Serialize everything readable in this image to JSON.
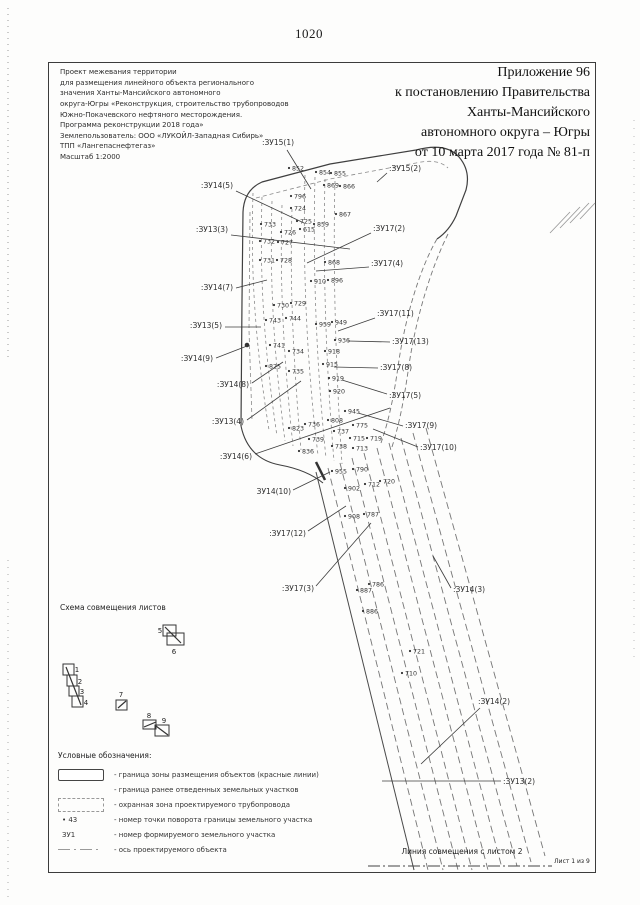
{
  "page": {
    "number": "1020",
    "match_line_label": "Линия совмещения с листом 2",
    "sheet_note": "Лист 1 из 9"
  },
  "header": {
    "title_lines": [
      "Приложение 96",
      "к постановлению Правительства",
      "Ханты-Мансийского",
      "автономного округа – Югры",
      "от 10 марта 2017 года № 81-п"
    ]
  },
  "project_info": {
    "lines": [
      "Проект межевания территории",
      "для размещения линейного объекта регионального",
      "значения Ханты-Мансийского автономного",
      "округа-Югры «Реконструкция, строительство трубопроводов",
      "Южно-Покачевского нефтяного месторождения.",
      "Программа реконструкции 2018 года»",
      "Землепользователь: ООО «ЛУКОЙЛ-Западная Сибирь»",
      "ТПП «Лангепаснефтегаз»",
      "Масштаб 1:2000"
    ]
  },
  "scheme": {
    "title": "Схема совмещения листов",
    "sheets": [
      {
        "n": "1",
        "x": 63,
        "y": 664,
        "w": 11,
        "h": 11,
        "nx": 77,
        "ny": 672
      },
      {
        "n": "2",
        "x": 67,
        "y": 675,
        "w": 10,
        "h": 11,
        "nx": 80,
        "ny": 684
      },
      {
        "n": "3",
        "x": 69,
        "y": 686,
        "w": 10,
        "h": 10,
        "nx": 82,
        "ny": 694
      },
      {
        "n": "4",
        "x": 72,
        "y": 696,
        "w": 11,
        "h": 11,
        "nx": 86,
        "ny": 705
      },
      {
        "n": "5",
        "x": 163,
        "y": 625,
        "w": 13,
        "h": 11,
        "nx": 160,
        "ny": 633
      },
      {
        "n": "6",
        "x": 167,
        "y": 633,
        "w": 17,
        "h": 12,
        "nx": 174,
        "ny": 654
      },
      {
        "n": "7",
        "x": 116,
        "y": 700,
        "w": 11,
        "h": 10,
        "nx": 121,
        "ny": 697
      },
      {
        "n": "8",
        "x": 143,
        "y": 720,
        "w": 13,
        "h": 9,
        "nx": 149,
        "ny": 718
      },
      {
        "n": "9",
        "x": 155,
        "y": 725,
        "w": 14,
        "h": 11,
        "nx": 164,
        "ny": 723
      }
    ],
    "links": [
      "M66,667 L81,705",
      "M165,627 L181,643",
      "M118,708 L126,701",
      "M144,727 L156,722",
      "M156,726 L168,735"
    ]
  },
  "legend": {
    "title": "Условные обозначения:",
    "items": [
      {
        "symbol": "solid-rect",
        "symbol_text": "",
        "text": "- граница зоны размещения объектов (красные линии)"
      },
      {
        "symbol": "none",
        "symbol_text": "",
        "text": "- граница ранее отведенных земельных участков"
      },
      {
        "symbol": "dashed-rect",
        "symbol_text": "",
        "text": "- охранная зона проектируемого трубопровода"
      },
      {
        "symbol": "point",
        "symbol_text": "• 43",
        "text": "- номер точки поворота границы земельного участка"
      },
      {
        "symbol": "zu",
        "symbol_text": "ЗУ1",
        "text": "- номер формируемого земельного участка"
      },
      {
        "symbol": "axis",
        "symbol_text": "",
        "text": "- ось проектируемого объекта"
      }
    ]
  },
  "map": {
    "colors": {
      "boundary": "#3f3f3f",
      "corridor": "#757575",
      "inner": "#8a8a8a",
      "leader": "#3d3d3d",
      "text": "#2e2e2e"
    },
    "paths": [
      {
        "name": "zone-boundary",
        "d": "M241,426 L242,300 L243,212 Q244,190 262,182 L330,164 L416,150 Q446,142 459,157 Q471,171 466,190 L456,216 Q449,231 437,239",
        "w": 1.2,
        "c": "#3f3f3f"
      },
      {
        "name": "zone-boundary-inner-top",
        "d": "M256,198 L330,179 L416,163 Q438,158 448,168",
        "w": 0.8,
        "c": "#8a8a8a",
        "dash": "4,3"
      },
      {
        "name": "zone-boundary-inner-left",
        "d": "M250,212 L249,330 L252,420",
        "w": 0.8,
        "c": "#8a8a8a",
        "dash": "4,3"
      },
      {
        "name": "zone-boundary-bottom-curve",
        "d": "M241,426 Q248,459 280,465 Q307,470 323,483",
        "w": 1.1,
        "c": "#3f3f3f"
      },
      {
        "name": "corridor-right-1",
        "d": "M437,239 C420,268 406,315 399,360 C394,396 389,420 381,443",
        "w": 0.9,
        "c": "#777777",
        "dash": "5,3"
      },
      {
        "name": "corridor-right-2",
        "d": "M448,234 C431,268 416,318 409,365 C404,400 399,426 391,450",
        "w": 0.9,
        "c": "#777777",
        "dash": "5,3"
      },
      {
        "name": "corridor-v1",
        "d": "M253,193 C251,260 253,330 269,430",
        "w": 0.8,
        "c": "#8a8a8a",
        "dash": "3,3"
      },
      {
        "name": "corridor-v2",
        "d": "M262,197 C260,265 262,335 277,436",
        "w": 0.8,
        "c": "#8a8a8a",
        "dash": "3,3"
      },
      {
        "name": "corridor-v3",
        "d": "M272,201 C270,270 272,340 285,441",
        "w": 0.8,
        "c": "#8a8a8a",
        "dash": "3,3"
      },
      {
        "name": "corridor-v4",
        "d": "M282,205 C280,272 282,342 293,446",
        "w": 0.8,
        "c": "#8a8a8a",
        "dash": "3,3"
      },
      {
        "name": "corridor-v5",
        "d": "M292,209 C290,275 292,345 301,450",
        "w": 0.8,
        "c": "#8a8a8a",
        "dash": "3,3"
      },
      {
        "name": "corridor-v6",
        "d": "M305,175 C303,250 305,350 318,455",
        "w": 0.8,
        "c": "#8a8a8a",
        "dash": "3,3"
      },
      {
        "name": "corridor-v7",
        "d": "M315,177 C313,252 315,352 326,458",
        "w": 0.8,
        "c": "#8a8a8a",
        "dash": "3,3"
      },
      {
        "name": "corridor-v8",
        "d": "M325,179 C323,255 325,355 334,461",
        "w": 0.8,
        "c": "#8a8a8a",
        "dash": "3,3"
      },
      {
        "name": "corridor-v9",
        "d": "M335,181 C333,258 335,358 342,464",
        "w": 0.8,
        "c": "#8a8a8a",
        "dash": "3,3"
      },
      {
        "name": "corridor-l1",
        "d": "M316,472 L414,870",
        "w": 1.0,
        "c": "#4a4a4a"
      },
      {
        "name": "corridor-l2",
        "d": "M328,468 L428,870",
        "w": 0.9,
        "c": "#757575",
        "dash": "7,4"
      },
      {
        "name": "corridor-l3",
        "d": "M340,463 L443,870",
        "w": 0.9,
        "c": "#757575",
        "dash": "7,4"
      },
      {
        "name": "corridor-l4",
        "d": "M352,458 L458,870",
        "w": 0.9,
        "c": "#757575",
        "dash": "7,4"
      },
      {
        "name": "corridor-l5",
        "d": "M364,453 L472,870",
        "w": 0.9,
        "c": "#757575",
        "dash": "7,4"
      },
      {
        "name": "corridor-l6",
        "d": "M377,448 L488,870",
        "w": 0.9,
        "c": "#757575",
        "dash": "7,4"
      },
      {
        "name": "corridor-l7",
        "d": "M389,443 L502,868",
        "w": 0.9,
        "c": "#757575",
        "dash": "7,4"
      },
      {
        "name": "corridor-l8",
        "d": "M401,438 L517,866",
        "w": 0.9,
        "c": "#757575",
        "dash": "7,4"
      },
      {
        "name": "corridor-l9",
        "d": "M413,433 L531,862",
        "w": 0.9,
        "c": "#757575",
        "dash": "7,4"
      },
      {
        "name": "corridor-l10",
        "d": "M426,428 L545,856",
        "w": 0.9,
        "c": "#757575",
        "dash": "7,4"
      },
      {
        "name": "scan-hatch-1",
        "d": "M550,233 L570,212",
        "w": 0.9,
        "c": "#9a9a9a"
      },
      {
        "name": "scan-hatch-2",
        "d": "M560,228 L580,207",
        "w": 0.9,
        "c": "#9a9a9a"
      },
      {
        "name": "scan-hatch-3",
        "d": "M570,223 L589,203",
        "w": 0.9,
        "c": "#9a9a9a"
      },
      {
        "name": "scan-hatch-4",
        "d": "M580,219 L595,203",
        "w": 0.9,
        "c": "#9a9a9a"
      },
      {
        "name": "margin-dots-left-top",
        "d": "M8,8 L8,360",
        "w": 1,
        "c": "#999999",
        "dash": "1,5"
      },
      {
        "name": "margin-dots-left-bottom",
        "d": "M8,560 L8,898",
        "w": 1,
        "c": "#aaaaaa",
        "dash": "1,6"
      },
      {
        "name": "margin-dots-right",
        "d": "M634,120 L634,660",
        "w": 1,
        "c": "#bbbbbb",
        "dash": "1,7"
      },
      {
        "name": "match-line",
        "d": "M368,866 L552,866",
        "w": 1,
        "c": "#444444",
        "dash": "12,3,2,3"
      },
      {
        "name": "axis-bold-mark",
        "d": "M316,462 L325,480",
        "w": 2.5,
        "c": "#333333"
      }
    ],
    "bold_marks": [
      {
        "x": 247,
        "y": 345
      }
    ],
    "points": [
      {
        "n": "852",
        "x": 289,
        "y": 168
      },
      {
        "n": "854",
        "x": 316,
        "y": 172
      },
      {
        "n": "855",
        "x": 331,
        "y": 173
      },
      {
        "n": "869",
        "x": 324,
        "y": 185
      },
      {
        "n": "866",
        "x": 340,
        "y": 186
      },
      {
        "n": "796",
        "x": 291,
        "y": 196
      },
      {
        "n": "724",
        "x": 291,
        "y": 208
      },
      {
        "n": "733",
        "x": 261,
        "y": 224
      },
      {
        "n": "725",
        "x": 297,
        "y": 221
      },
      {
        "n": "726",
        "x": 281,
        "y": 232
      },
      {
        "n": "615",
        "x": 300,
        "y": 229
      },
      {
        "n": "859",
        "x": 314,
        "y": 224
      },
      {
        "n": "867",
        "x": 336,
        "y": 214
      },
      {
        "n": "732",
        "x": 260,
        "y": 241
      },
      {
        "n": "727",
        "x": 278,
        "y": 242
      },
      {
        "n": "731",
        "x": 260,
        "y": 260
      },
      {
        "n": "728",
        "x": 277,
        "y": 260
      },
      {
        "n": "868",
        "x": 325,
        "y": 262
      },
      {
        "n": "910",
        "x": 311,
        "y": 281
      },
      {
        "n": "896",
        "x": 328,
        "y": 280
      },
      {
        "n": "730",
        "x": 274,
        "y": 305
      },
      {
        "n": "729",
        "x": 291,
        "y": 303
      },
      {
        "n": "743",
        "x": 266,
        "y": 320
      },
      {
        "n": "744",
        "x": 286,
        "y": 318
      },
      {
        "n": "959",
        "x": 316,
        "y": 324
      },
      {
        "n": "949",
        "x": 332,
        "y": 322
      },
      {
        "n": "936",
        "x": 335,
        "y": 340
      },
      {
        "n": "741",
        "x": 270,
        "y": 345
      },
      {
        "n": "734",
        "x": 289,
        "y": 351
      },
      {
        "n": "918",
        "x": 325,
        "y": 351
      },
      {
        "n": "915",
        "x": 323,
        "y": 364
      },
      {
        "n": "825",
        "x": 266,
        "y": 366
      },
      {
        "n": "735",
        "x": 289,
        "y": 371
      },
      {
        "n": "919",
        "x": 329,
        "y": 378
      },
      {
        "n": "920",
        "x": 330,
        "y": 391
      },
      {
        "n": "945",
        "x": 345,
        "y": 411
      },
      {
        "n": "823",
        "x": 289,
        "y": 428
      },
      {
        "n": "736",
        "x": 305,
        "y": 424
      },
      {
        "n": "808",
        "x": 328,
        "y": 420
      },
      {
        "n": "775",
        "x": 353,
        "y": 425
      },
      {
        "n": "737",
        "x": 334,
        "y": 431
      },
      {
        "n": "739",
        "x": 309,
        "y": 439
      },
      {
        "n": "715",
        "x": 350,
        "y": 438
      },
      {
        "n": "719",
        "x": 367,
        "y": 438
      },
      {
        "n": "738",
        "x": 332,
        "y": 446
      },
      {
        "n": "713",
        "x": 353,
        "y": 448
      },
      {
        "n": "836",
        "x": 299,
        "y": 451
      },
      {
        "n": "955",
        "x": 332,
        "y": 471
      },
      {
        "n": "790",
        "x": 353,
        "y": 469
      },
      {
        "n": "902",
        "x": 345,
        "y": 488
      },
      {
        "n": "712",
        "x": 365,
        "y": 484
      },
      {
        "n": "720",
        "x": 380,
        "y": 481
      },
      {
        "n": "908",
        "x": 345,
        "y": 516
      },
      {
        "n": "787",
        "x": 364,
        "y": 514
      },
      {
        "n": "786",
        "x": 369,
        "y": 584
      },
      {
        "n": "887",
        "x": 357,
        "y": 590
      },
      {
        "n": "886",
        "x": 363,
        "y": 611
      },
      {
        "n": "721",
        "x": 410,
        "y": 651
      },
      {
        "n": "710",
        "x": 402,
        "y": 673
      }
    ],
    "zone_labels": [
      {
        "t": ":ЗУ15(1)",
        "x": 278,
        "y": 145,
        "a": "middle",
        "l": [
          287,
          150,
          311,
          189
        ]
      },
      {
        "t": ":ЗУ15(2)",
        "x": 389,
        "y": 171,
        "a": "start",
        "l": [
          387,
          173,
          377,
          182
        ]
      },
      {
        "t": ":ЗУ14(5)",
        "x": 233,
        "y": 188,
        "a": "end",
        "l": [
          236,
          191,
          304,
          223
        ]
      },
      {
        "t": ":ЗУ13(3)",
        "x": 228,
        "y": 232,
        "a": "end",
        "l": [
          231,
          235,
          350,
          249
        ]
      },
      {
        "t": ":ЗУ14(7)",
        "x": 233,
        "y": 290,
        "a": "end",
        "l": [
          236,
          288,
          267,
          280
        ]
      },
      {
        "t": ":ЗУ13(5)",
        "x": 222,
        "y": 328,
        "a": "end",
        "l": [
          225,
          327,
          261,
          327
        ]
      },
      {
        "t": ":ЗУ14(9)",
        "x": 213,
        "y": 361,
        "a": "end",
        "l": [
          216,
          358,
          247,
          346
        ]
      },
      {
        "t": ":ЗУ14(8)",
        "x": 249,
        "y": 387,
        "a": "end",
        "l": [
          252,
          383,
          283,
          362
        ]
      },
      {
        "t": ":ЗУ13(4)",
        "x": 244,
        "y": 424,
        "a": "end",
        "l": [
          247,
          420,
          301,
          381
        ]
      },
      {
        "t": ":ЗУ14(6)",
        "x": 252,
        "y": 459,
        "a": "end",
        "l": [
          255,
          454,
          390,
          408
        ]
      },
      {
        "t": ":ЗУ17(2)",
        "x": 373,
        "y": 231,
        "a": "start",
        "l": [
          371,
          233,
          307,
          263
        ]
      },
      {
        "t": ":ЗУ17(4)",
        "x": 371,
        "y": 266,
        "a": "start",
        "l": [
          369,
          267,
          316,
          271
        ]
      },
      {
        "t": ":ЗУ17(11)",
        "x": 377,
        "y": 316,
        "a": "start",
        "l": [
          375,
          318,
          338,
          331
        ]
      },
      {
        "t": ":ЗУ17(13)",
        "x": 392,
        "y": 344,
        "a": "start",
        "l": [
          390,
          342,
          348,
          341
        ]
      },
      {
        "t": ":ЗУ17(8)",
        "x": 380,
        "y": 370,
        "a": "start",
        "l": [
          378,
          368,
          334,
          367
        ]
      },
      {
        "t": ":ЗУ17(5)",
        "x": 389,
        "y": 398,
        "a": "start",
        "l": [
          387,
          394,
          342,
          380
        ]
      },
      {
        "t": ":ЗУ17(9)",
        "x": 405,
        "y": 428,
        "a": "start",
        "l": [
          403,
          426,
          358,
          413
        ]
      },
      {
        "t": ":ЗУ17(10)",
        "x": 420,
        "y": 450,
        "a": "start",
        "l": [
          418,
          447,
          373,
          429
        ]
      },
      {
        "t": "ЗУ14(10)",
        "x": 291,
        "y": 494,
        "a": "end",
        "l": [
          293,
          490,
          330,
          472
        ]
      },
      {
        "t": ":ЗУ17(12)",
        "x": 306,
        "y": 536,
        "a": "end",
        "l": [
          308,
          531,
          346,
          506
        ]
      },
      {
        "t": ":ЗУ17(3)",
        "x": 314,
        "y": 591,
        "a": "end",
        "l": [
          316,
          586,
          371,
          523
        ]
      },
      {
        "t": ":ЗУ14(3)",
        "x": 453,
        "y": 592,
        "a": "start",
        "l": [
          451,
          588,
          433,
          556
        ]
      },
      {
        "t": ":ЗУ14(2)",
        "x": 478,
        "y": 704,
        "a": "start",
        "l": [
          480,
          708,
          421,
          764
        ]
      },
      {
        "t": ":ЗУ13(2)",
        "x": 503,
        "y": 784,
        "a": "start",
        "l": [
          501,
          781,
          382,
          781
        ]
      }
    ]
  }
}
